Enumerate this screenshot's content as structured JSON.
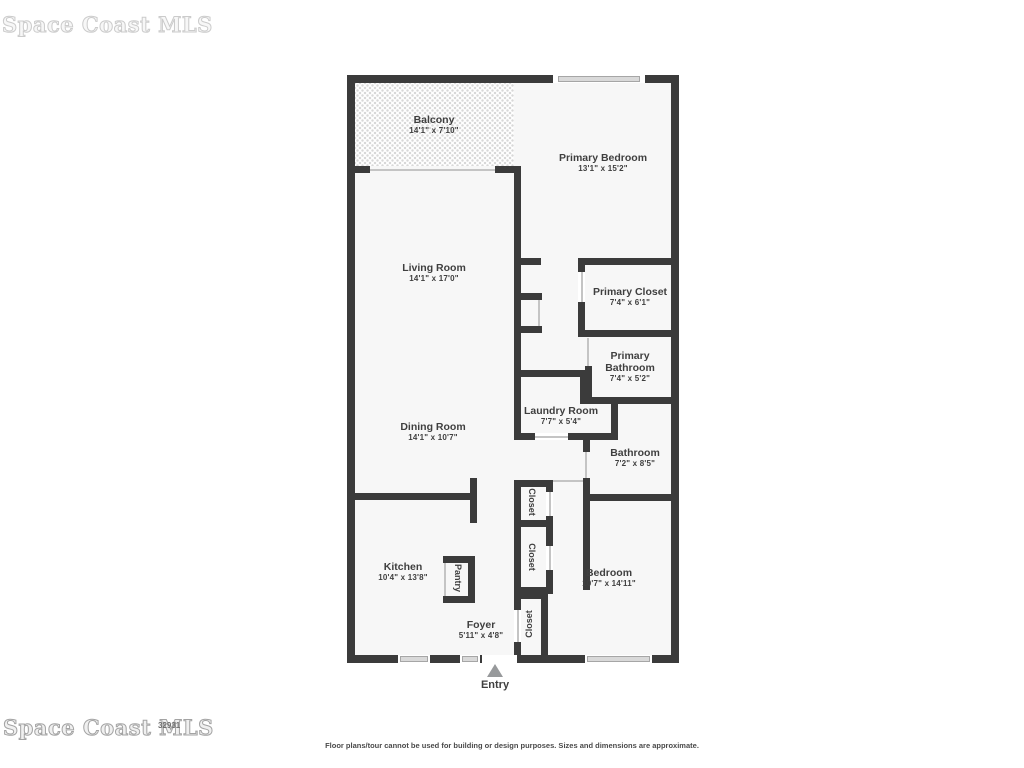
{
  "plan": {
    "rooms": {
      "balcony": {
        "name": "Balcony",
        "dims": "14'1\" x 7'10\""
      },
      "living": {
        "name": "Living Room",
        "dims": "14'1\" x 17'0\""
      },
      "dining": {
        "name": "Dining Room",
        "dims": "14'1\" x 10'7\""
      },
      "kitchen": {
        "name": "Kitchen",
        "dims": "10'4\" x 13'8\""
      },
      "pantry": {
        "name": "Pantry"
      },
      "foyer": {
        "name": "Foyer",
        "dims": "5'11\" x 4'8\""
      },
      "primary_bedroom": {
        "name": "Primary Bedroom",
        "dims": "13'1\" x 15'2\""
      },
      "primary_closet": {
        "name": "Primary Closet",
        "dims": "7'4\" x 6'1\""
      },
      "primary_bathroom": {
        "name_line1": "Primary",
        "name_line2": "Bathroom",
        "dims": "7'4\" x 5'2\""
      },
      "laundry": {
        "name": "Laundry Room",
        "dims": "7'7\" x 5'4\""
      },
      "bathroom": {
        "name": "Bathroom",
        "dims": "7'2\" x 8'5\""
      },
      "bedroom": {
        "name": "Bedroom",
        "dims": "10'7\" x 14'11\""
      },
      "closet1": {
        "name": "Closet"
      },
      "closet2": {
        "name": "Closet"
      },
      "closet3": {
        "name": "Closet"
      }
    },
    "entry_label": "Entry"
  },
  "watermark": {
    "top_text": "Space Coast MLS",
    "bottom_text": "Space Coast MLS",
    "zip": "32931"
  },
  "footer": {
    "disclaimer": "Floor plans/tour cannot be used for building or design purposes. Sizes and dimensions are approximate."
  },
  "colors": {
    "wall": "#3b3b3b",
    "room_fill": "#f7f7f7",
    "window_glass": "#d9d9d9",
    "entry_arrow": "#97999b",
    "text": "#3f3f3f"
  }
}
